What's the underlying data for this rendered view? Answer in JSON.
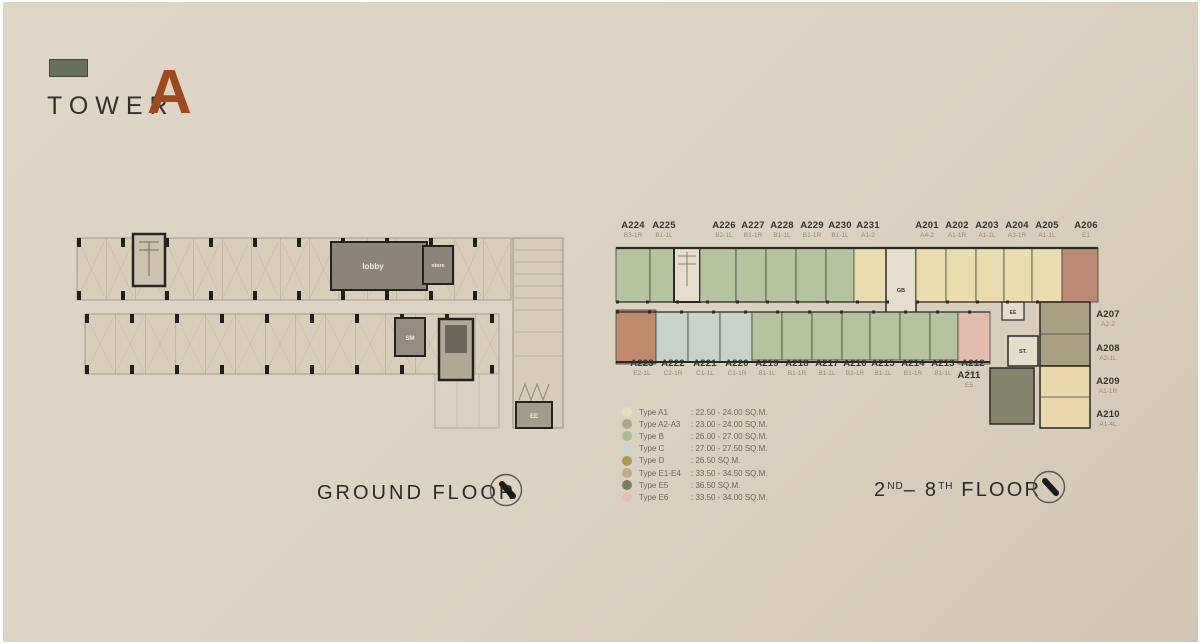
{
  "title": {
    "tower": "TOWER",
    "letter": "A",
    "accent_color": "#9c4a22",
    "swatch_color": "#68705a"
  },
  "floors": {
    "ground": {
      "label": "GROUND FLOOR"
    },
    "upper": {
      "n1": "2",
      "s1": "ND",
      "mid": "– ",
      "n2": "8",
      "s2": "TH",
      "rest": " FLOOR"
    }
  },
  "ground_rooms": {
    "lobby": "lobby",
    "store": "store",
    "sm": "SM",
    "ee": "EE"
  },
  "plan_rooms": {
    "gb": "GB",
    "ee": "EE",
    "st": "ST."
  },
  "plan_colors": {
    "green": "#b5c39e",
    "cream": "#ebdcb0",
    "blue": "#c6d2ca",
    "salmon": "#c08a6d",
    "pink": "#e4bcae",
    "olive": "#84826a",
    "wingtan": "#a99f83",
    "wingcream": "#e9d8ac",
    "terra": "#ba8a72",
    "corefill": "#e6ddcc",
    "wall": "#2b2925"
  },
  "units": {
    "top": [
      {
        "id": "A224",
        "sub": "B3-1R",
        "x": 633
      },
      {
        "id": "A225",
        "sub": "B1-1L",
        "x": 664
      },
      {
        "id": "A226",
        "sub": "B2-1L",
        "x": 724
      },
      {
        "id": "A227",
        "sub": "B1-1R",
        "x": 753
      },
      {
        "id": "A228",
        "sub": "B1-1L",
        "x": 782
      },
      {
        "id": "A229",
        "sub": "B1-1R",
        "x": 812
      },
      {
        "id": "A230",
        "sub": "B1-1L",
        "x": 840
      },
      {
        "id": "A231",
        "sub": "A1-2",
        "x": 868
      },
      {
        "id": "A201",
        "sub": "A4-2",
        "x": 927
      },
      {
        "id": "A202",
        "sub": "A1-1R",
        "x": 957
      },
      {
        "id": "A203",
        "sub": "A1-1L",
        "x": 987
      },
      {
        "id": "A204",
        "sub": "A3-1R",
        "x": 1017
      },
      {
        "id": "A205",
        "sub": "A1-1L",
        "x": 1047
      },
      {
        "id": "A206",
        "sub": "E1",
        "x": 1086
      }
    ],
    "bottom": [
      {
        "id": "A223",
        "sub": "E2-1L",
        "x": 642
      },
      {
        "id": "A222",
        "sub": "C2-1R",
        "x": 673
      },
      {
        "id": "A221",
        "sub": "C1-1L",
        "x": 705
      },
      {
        "id": "A220",
        "sub": "C1-1R",
        "x": 737
      },
      {
        "id": "A219",
        "sub": "B1-1L",
        "x": 767
      },
      {
        "id": "A218",
        "sub": "B1-1R",
        "x": 797
      },
      {
        "id": "A217",
        "sub": "B1-1L",
        "x": 827
      },
      {
        "id": "A216",
        "sub": "B1-1R",
        "x": 855
      },
      {
        "id": "A215",
        "sub": "B1-1L",
        "x": 883
      },
      {
        "id": "A214",
        "sub": "B1-1R",
        "x": 913
      },
      {
        "id": "A213",
        "sub": "B1-1L",
        "x": 943
      },
      {
        "id": "A212",
        "sub": "E6-1",
        "x": 973
      }
    ],
    "right": [
      {
        "id": "A207",
        "sub": "A2-2",
        "y": 310
      },
      {
        "id": "A208",
        "sub": "A2-1L",
        "y": 344
      },
      {
        "id": "A209",
        "sub": "A1-1R",
        "y": 377
      },
      {
        "id": "A210",
        "sub": "A1-4L",
        "y": 410
      }
    ],
    "single": {
      "id": "A211",
      "sub": "E5"
    }
  },
  "legend": {
    "items": [
      {
        "type": "Type A1",
        "range": ": 22.50 - 24.00 SQ.M.",
        "color": "#e9dcbd"
      },
      {
        "type": "Type A2-A3",
        "range": ": 23.00 - 24.00 SQ.M.",
        "color": "#b2a489"
      },
      {
        "type": "Type B",
        "range": ": 26.00 - 27.00 SQ.M.",
        "color": "#a9bb90"
      },
      {
        "type": "Type C",
        "range": ": 27.00 - 27.50 SQ.M.",
        "color": "#cad5cd"
      },
      {
        "type": "Type D",
        "range": ": 26.50 SQ.M.",
        "color": "#a89a50"
      },
      {
        "type": "Type E1-E4",
        "range": ": 33.50 - 34.50 SQ.M.",
        "color": "#c2a88c"
      },
      {
        "type": "Type E5",
        "range": ": 36.50 SQ.M.",
        "color": "#7d7c5c"
      },
      {
        "type": "Type E6",
        "range": ": 33.50 - 34.00 SQ.M.",
        "color": "#e5bfb5"
      }
    ]
  }
}
